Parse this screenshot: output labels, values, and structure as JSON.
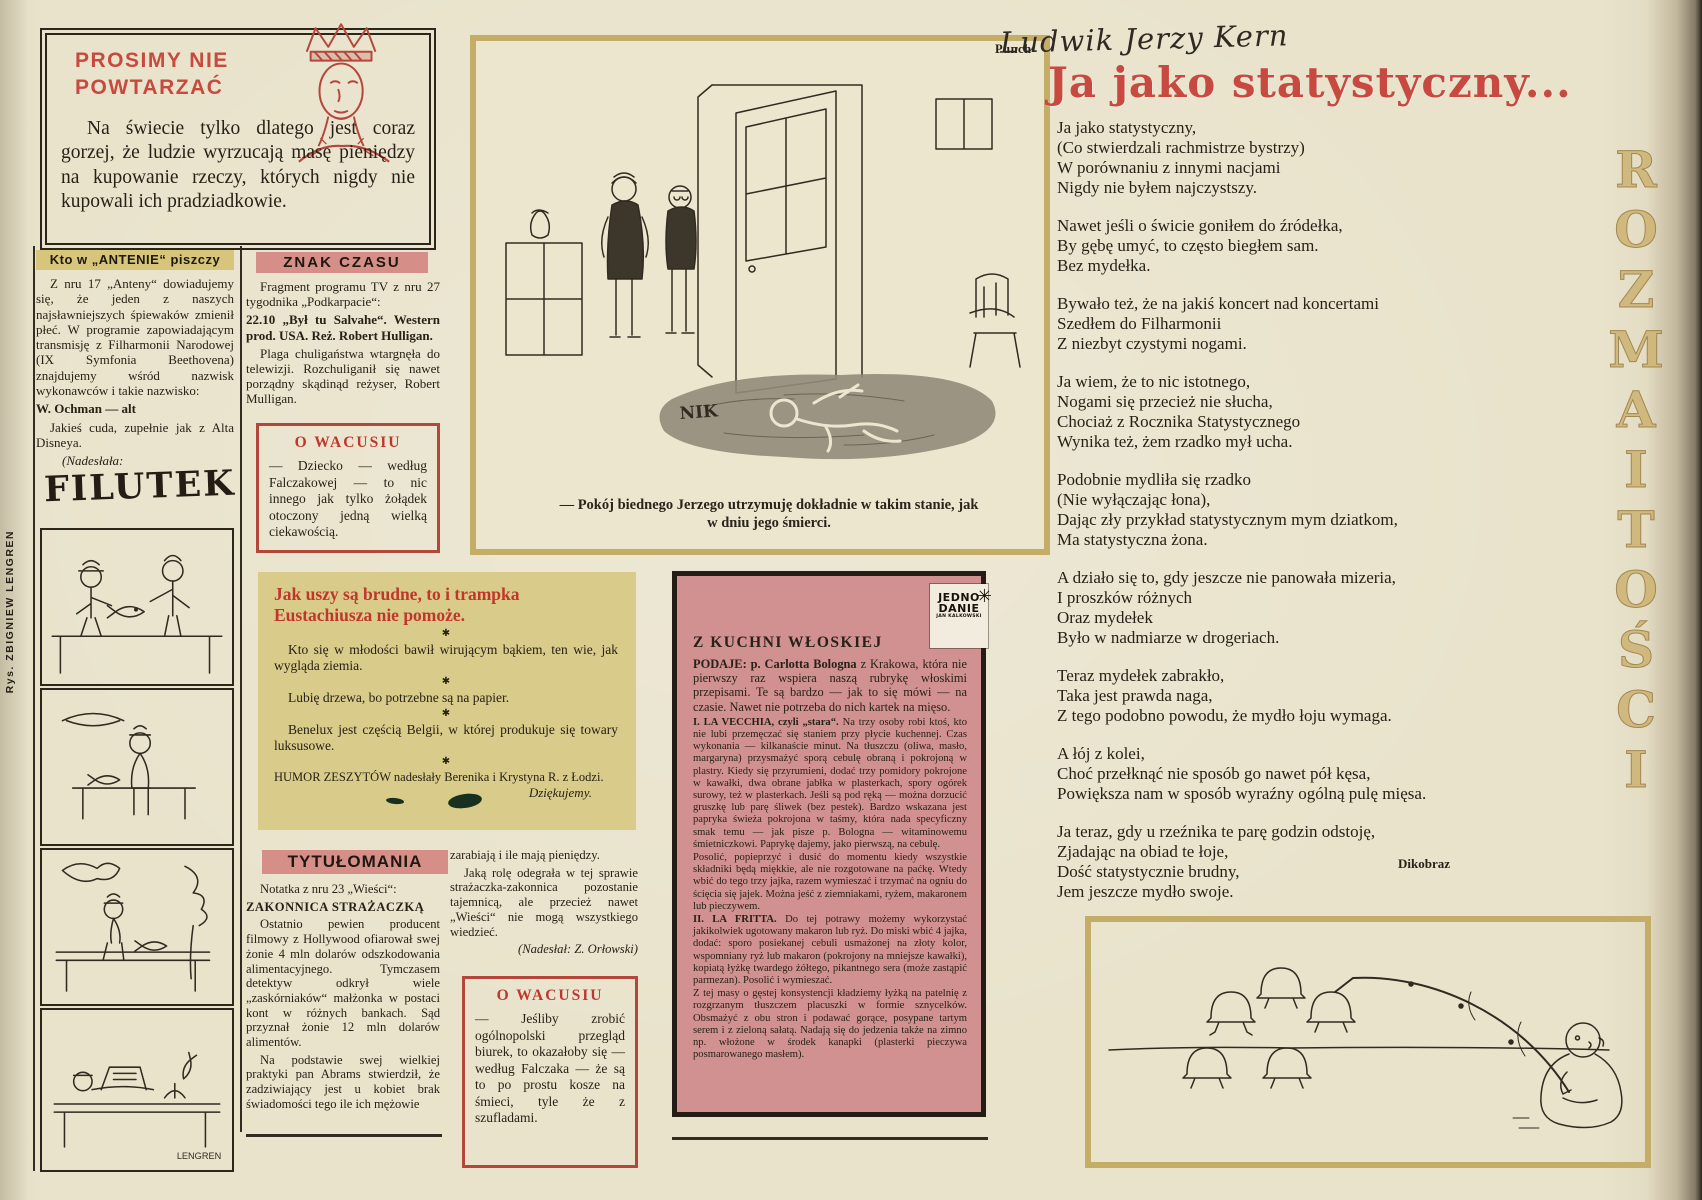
{
  "edge": {
    "credit": "Rys. ZBIGNIEW LENGREN",
    "vertical_letters": [
      "R",
      "O",
      "Z",
      "M",
      "A",
      "I",
      "T",
      "O",
      "Ś",
      "C",
      "I"
    ]
  },
  "prosimy": {
    "title_line1": "PROSIMY NIE",
    "title_line2": "POWTARZAĆ",
    "body": "Na świecie tylko dlatego jest coraz gorzej, że ludzie wyrzucają masę pieniędzy na kupowanie rzeczy, których nigdy nie kupowali ich pradziadkowie."
  },
  "antena": {
    "header": "Kto w „ANTENIE“ piszczy",
    "p1": "Z nru 17 „Anteny“ dowiadujemy się, że jeden z naszych najsławniejszych śpiewaków zmienił płeć. W programie zapowiadającym transmisję z Filharmonii Narodowej (IX Symfonia Beethovena) znajdujemy wśród nazwisk wykonawców i takie nazwisko:",
    "p2": "W. Ochman — alt",
    "p3": "Jakieś cuda, zupełnie jak z Alta Disneya.",
    "p4": "(Nadesłała:",
    "p5": "E. Chyczyńska, też alt)"
  },
  "filutek": {
    "logo": "FILUTEK",
    "signature": "LENGREN"
  },
  "znak": {
    "header": "ZNAK CZASU",
    "p1": "Fragment programu TV z nru 27 tygodnika „Podkarpacie“:",
    "p2": "22.10 „Był tu Salvahe“. Western prod. USA. Reż. Robert Hulligan.",
    "p3": "Plaga chuligaństwa wtargnęła do telewizji. Rozchuliganił się nawet porządny skądinąd reżyser, Robert Mulligan.",
    "p4": "(Nadesłał: J. Kość)"
  },
  "wacusiu1": {
    "header": "O WACUSIU",
    "body": "— Dziecko — według Falczakowej — to nic innego jak tylko żołądek otoczony jedną wielką ciekawością."
  },
  "wacusiu2": {
    "header": "O WACUSIU",
    "body": "— Jeśliby zrobić ogólnopolski przegląd biurek, to okazałoby się — według Falczaka — że są to po prostu kosze na śmieci, tyle że z szufladami."
  },
  "humor": {
    "title": "Jak uszy są brudne, to i trampka Eustachiusza nie pomoże.",
    "separator": "✱",
    "items": [
      "Kto się w młodości bawił wirującym bąkiem, ten wie, jak wygląda ziemia.",
      "Lubię drzewa, bo potrzebne są na papier.",
      "Benelux jest częścią Belgii, w której produkuje się towary luksusowe."
    ],
    "credit": "HUMOR ZESZYTÓW nadesłały Berenika i Krystyna R. z Łodzi.",
    "thanks": "Dziękujemy."
  },
  "tytulomania": {
    "header": "TYTUŁOMANIA",
    "p1": "Notatka z nru 23 „Wieści“:",
    "p2": "ZAKONNICA STRAŻACZKĄ",
    "p3": "Ostatnio pewien producent filmowy z Hollywood ofiarował swej żonie 4 mln dolarów odszkodowania alimentacyjnego. Tymczasem detektyw odkrył wiele „zaskórniaków“ małżonka w postaci kont w różnych bankach. Sąd przyznał żonie 12 mln dolarów alimentów.",
    "p4": "Na podstawie swej wielkiej praktyki pan Abrams stwierdził, że zadziwiający jest u kobiet brak świadomości tego ile ich mężowie",
    "p5": "zarabiają i ile mają pieniędzy.",
    "p6": "Jaką rolę odegrała w tej sprawie strażaczka-zakonnica pozostanie tajemnicą, ale przecież nawet „Wieści“ nie mogą wszystkiego wiedzieć.",
    "p7": "(Nadesłał: Z. Orłowski)"
  },
  "punch": {
    "source_label": "Punch",
    "signature": "NIK",
    "caption": "— Pokój biednego Jerzego utrzymuję dokładnie w takim stanie, jak w dniu jego śmierci."
  },
  "kuchnia": {
    "logo_line1": "JEDNO",
    "logo_line2": "DANIE",
    "logo_line3": "JAN KALKOWSKI",
    "header": "Z KUCHNI WŁOSKIEJ",
    "intro_lead": "PODAJE: p. Carlotta Bologna",
    "intro_rest": "z Krakowa, która nie pierwszy raz wspiera naszą rubrykę włoskimi przepisami. Te są bardzo — jak to się mówi — na czasie. Nawet nie potrzeba do nich kartek na mięso.",
    "r1_lead": "I. LA VECCHIA, czyli „stara“.",
    "r1_rest": "Na trzy osoby robi ktoś, kto nie lubi przemęczać się staniem przy płycie kuchennej. Czas wykonania — kilkanaście minut. Na tłuszczu (oliwa, masło, margaryna) przysmażyć sporą cebulę obraną i pokrojoną w plastry. Kiedy się przyrumieni, dodać trzy pomidory pokrojone w kawałki, dwa obrane jabłka w plasterkach, spory ogórek surowy, też w plasterkach. Jeśli są pod ręką — można dorzucić gruszkę lub parę śliwek (bez pestek). Bardzo wskazana jest papryka świeża pokrojona w taśmy, która nada specyficzny smak temu — jak pisze p. Bologna — witaminowemu śmietniczkowi. Paprykę dajemy, jako pierwszą, na cebulę.",
    "r1b": "Posolić, popieprzyć i dusić do momentu kiedy wszystkie składniki będą miękkie, ale nie rozgotowane na paćkę. Wtedy wbić do tego trzy jajka, razem wymieszać i trzymać na ogniu do ścięcia się jajek. Można jeść z ziemniakami, ryżem, makaronem lub pieczywem.",
    "r2_lead": "II. LA FRITTA.",
    "r2_rest": "Do tej potrawy możemy wykorzystać jakikolwiek ugotowany makaron lub ryż. Do miski wbić 4 jajka, dodać: sporo posiekanej cebuli usmażonej na złoty kolor, wspomniany ryż lub makaron (pokrojony na mniejsze kawałki), kopiatą łyżkę twardego żółtego, pikantnego sera (może zastąpić parmezan). Posolić i wymieszać.",
    "r2b": "Z tej masy o gęstej konsystencji kładziemy łyżką na patelnię z rozgrzanym tłuszczem placuszki w formie sznycelków. Obsmażyć z obu stron i podawać gorące, posypane tartym serem i z zieloną sałatą. Nadają się do jedzenia także na zimno np. włożone w środek kanapki (plasterki pieczywa posmarowanego masłem)."
  },
  "poem": {
    "author": "Ludwik Jerzy Kern",
    "title": "Ja jako statystyczny...",
    "stanzas": [
      [
        "Ja jako statystyczny,",
        "(Co stwierdzali rachmistrze bystrzy)",
        "W porównaniu z innymi nacjami",
        "Nigdy nie byłem najczystszy."
      ],
      [
        "Nawet jeśli o świcie goniłem do źródełka,",
        "By gębę umyć, to często biegłem sam.",
        "Bez mydełka."
      ],
      [
        "Bywało też, że na jakiś koncert nad koncertami",
        "Szedłem do Filharmonii",
        "Z niezbyt czystymi nogami."
      ],
      [
        "Ja wiem, że to nic istotnego,",
        "Nogami się przecież nie słucha,",
        "Chociaż z Rocznika Statystycznego",
        "Wynika też, żem rzadko mył ucha."
      ],
      [
        "Podobnie mydliła się rzadko",
        "(Nie wyłączając łona),",
        "Dając zły przykład statystycznym mym dziatkom,",
        "Ma statystyczna żona."
      ],
      [
        "A działo się to, gdy jeszcze nie panowała mizeria,",
        "I proszków różnych",
        "Oraz mydełek",
        "Było w nadmiarze w drogeriach."
      ],
      [
        "Teraz mydełek zabrakło,",
        "Taka jest prawda naga,",
        "Z tego podobno powodu, że mydło łoju wymaga."
      ],
      [
        "A łój z kolei,",
        "Choć przełknąć nie sposób go nawet pół kęsa,",
        "Powiększa nam w sposób wyraźny ogólną pulę mięsa."
      ],
      [
        "Ja teraz, gdy u rzeźnika te parę godzin odstoję,",
        "Zjadając na obiad te łoje,",
        "Dość statystycznie brudny,",
        "Jem jeszcze mydło swoje."
      ]
    ]
  },
  "dikobraz": {
    "source_label": "Dikobraz"
  }
}
